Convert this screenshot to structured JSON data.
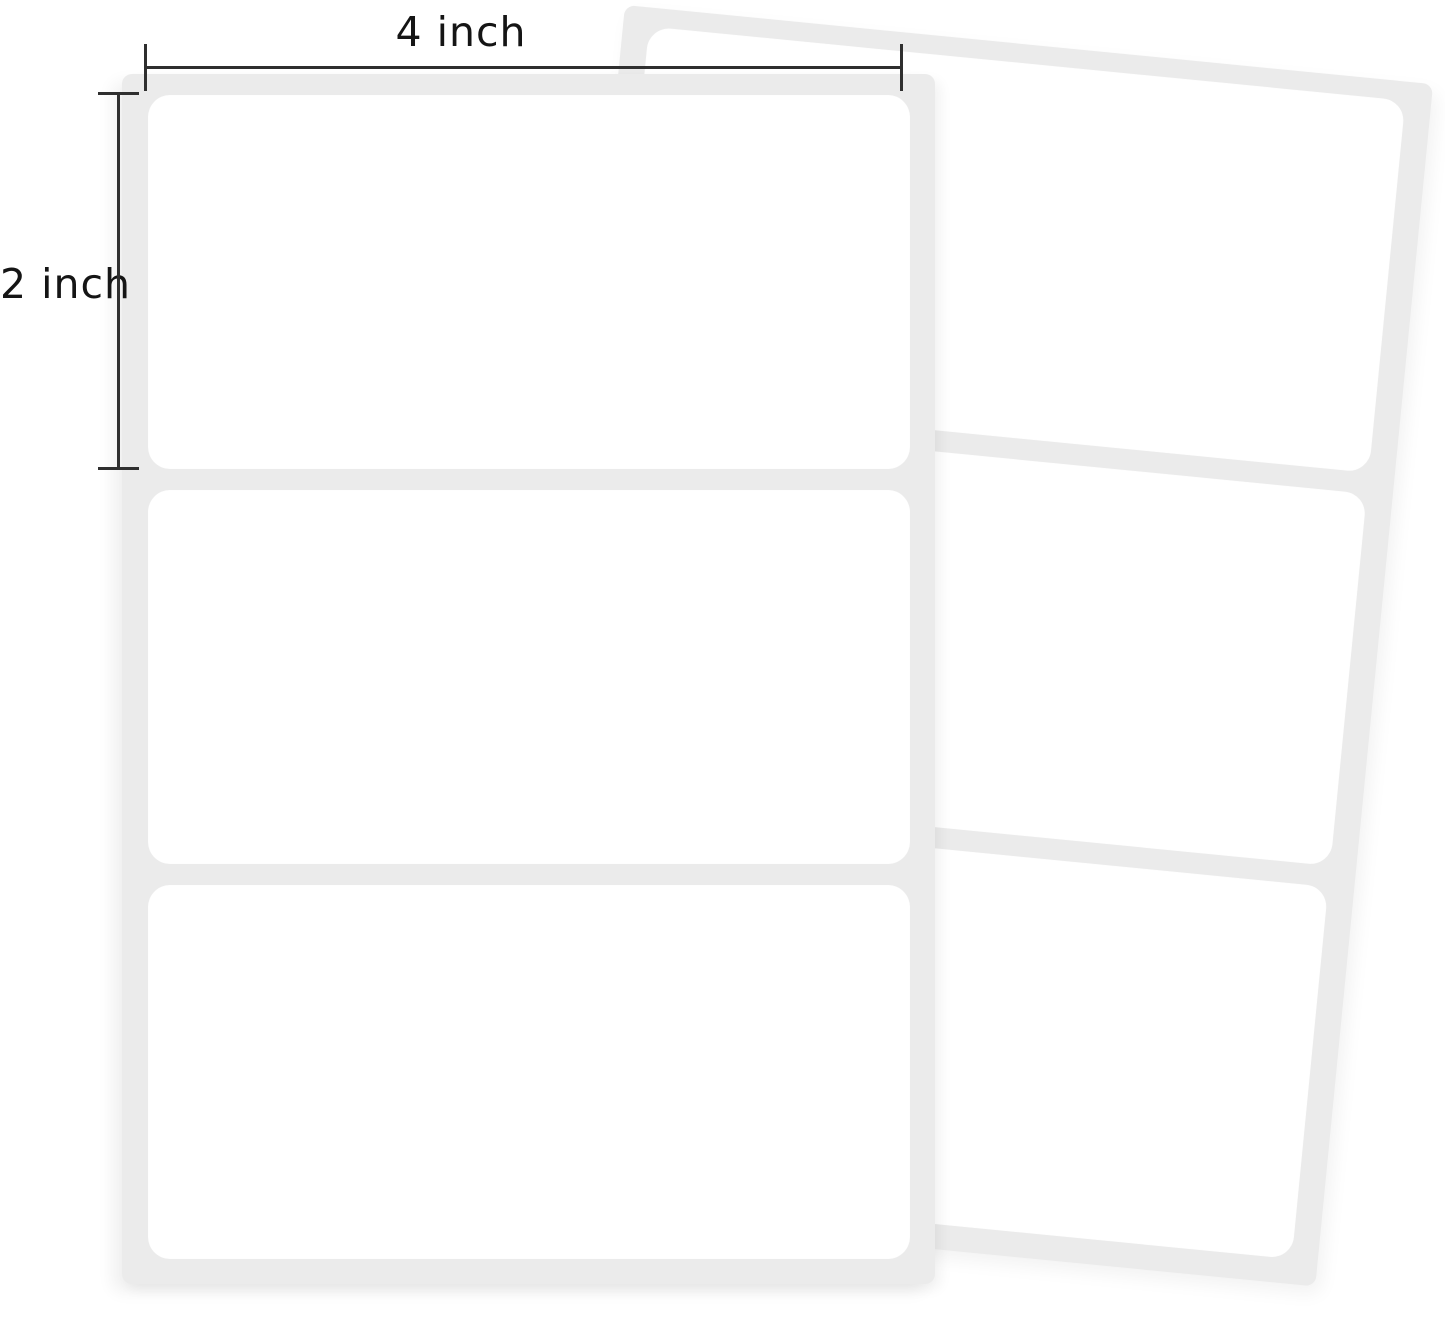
{
  "annotations": {
    "width_label": "4 inch",
    "height_label": "2 inch"
  },
  "sheets": {
    "front": {
      "labels_visible": 3
    },
    "back": {
      "labels_visible": 3
    }
  },
  "colors": {
    "background": "#ffffff",
    "sheet_backing": "#ebebeb",
    "label": "#ffffff",
    "dimension_line": "#2f2f2f",
    "annotation_text": "#151515"
  }
}
